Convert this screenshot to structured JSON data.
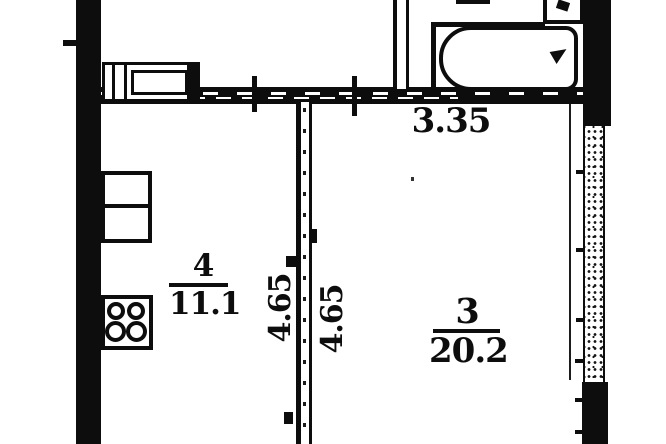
{
  "document": {
    "type": "apartment floor plan (scanned)"
  },
  "rooms": {
    "room4": {
      "number": "4",
      "area": "11.1"
    },
    "room3": {
      "number": "3",
      "area": "20.2"
    }
  },
  "dimensions": {
    "top_width_m": "3.35",
    "room4_depth_m": "4.65",
    "room3_depth_m": "4.65"
  },
  "fixtures": [
    "bathtub",
    "bathroom-sink",
    "kitchen-counter",
    "kitchen-cabinet",
    "stove-4-burner",
    "balcony-stippled-wall"
  ],
  "colors": {
    "ink": "#0d0d0d",
    "paper": "#ffffff"
  }
}
